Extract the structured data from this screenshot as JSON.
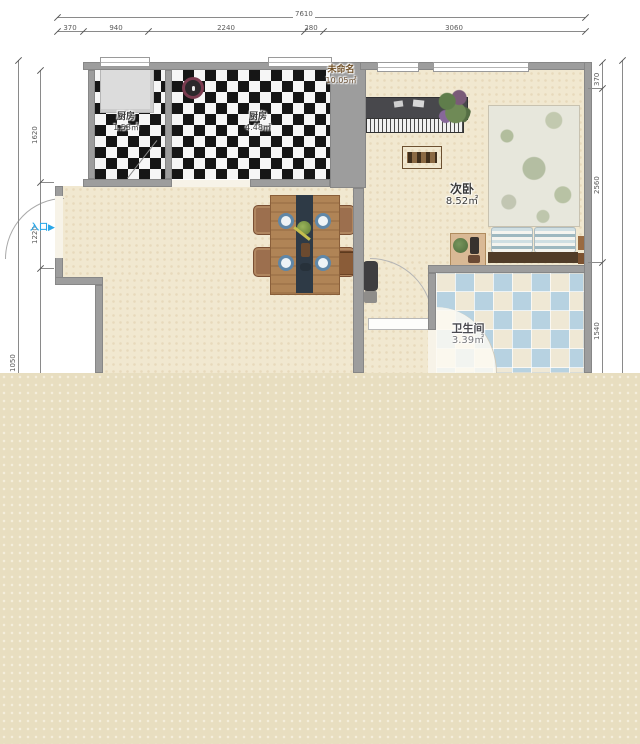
{
  "colors": {
    "wall": "#9d9d9d",
    "floor": "#f1e8d0",
    "tan_block": "#e8dec0",
    "tile_blue": "#b7d2e1",
    "entrance_blue": "#2aa7e8"
  },
  "dimensions": {
    "top_total": "7610",
    "top_segments": [
      "370",
      "940",
      "2240",
      "280",
      "3060"
    ],
    "left_segments": [
      "1620",
      "1220"
    ],
    "left_outer": "1050",
    "right_segments": [
      "370",
      "2560",
      "1540"
    ]
  },
  "rooms": {
    "unnamed": {
      "name": "未命名",
      "area": "10.05㎡"
    },
    "kitchen_small": {
      "name": "厨房",
      "area": "1.53㎡"
    },
    "kitchen": {
      "name": "厨房",
      "area": "4.48㎡"
    },
    "bedroom": {
      "name": "次卧",
      "area": "8.52㎡"
    },
    "bathroom": {
      "name": "卫生间",
      "area": "3.39㎡"
    }
  },
  "entrance": {
    "label": "入口",
    "arrow": "▶"
  }
}
